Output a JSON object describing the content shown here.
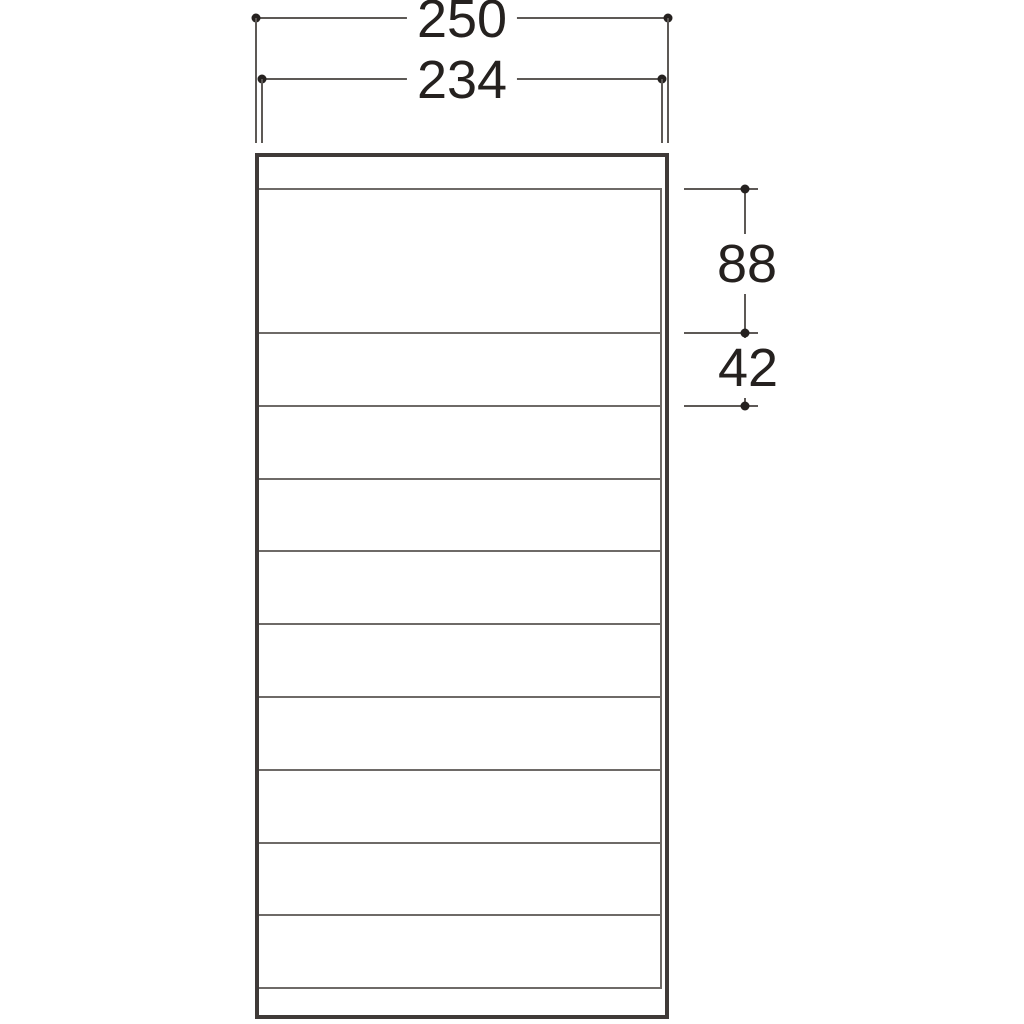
{
  "dimension_labels": {
    "outer_width": "250",
    "inner_width": "234",
    "top_compartment_height": "88",
    "shelf_spacing": "42"
  },
  "structure": {
    "shelf_line_count": 11,
    "compartment_count": 12
  },
  "colors": {
    "background": "#ffffff",
    "outline": "#3f3a38",
    "shelf_line": "#6e6a67",
    "dimension_line": "#5d5956",
    "dot_and_text": "#25211f"
  }
}
